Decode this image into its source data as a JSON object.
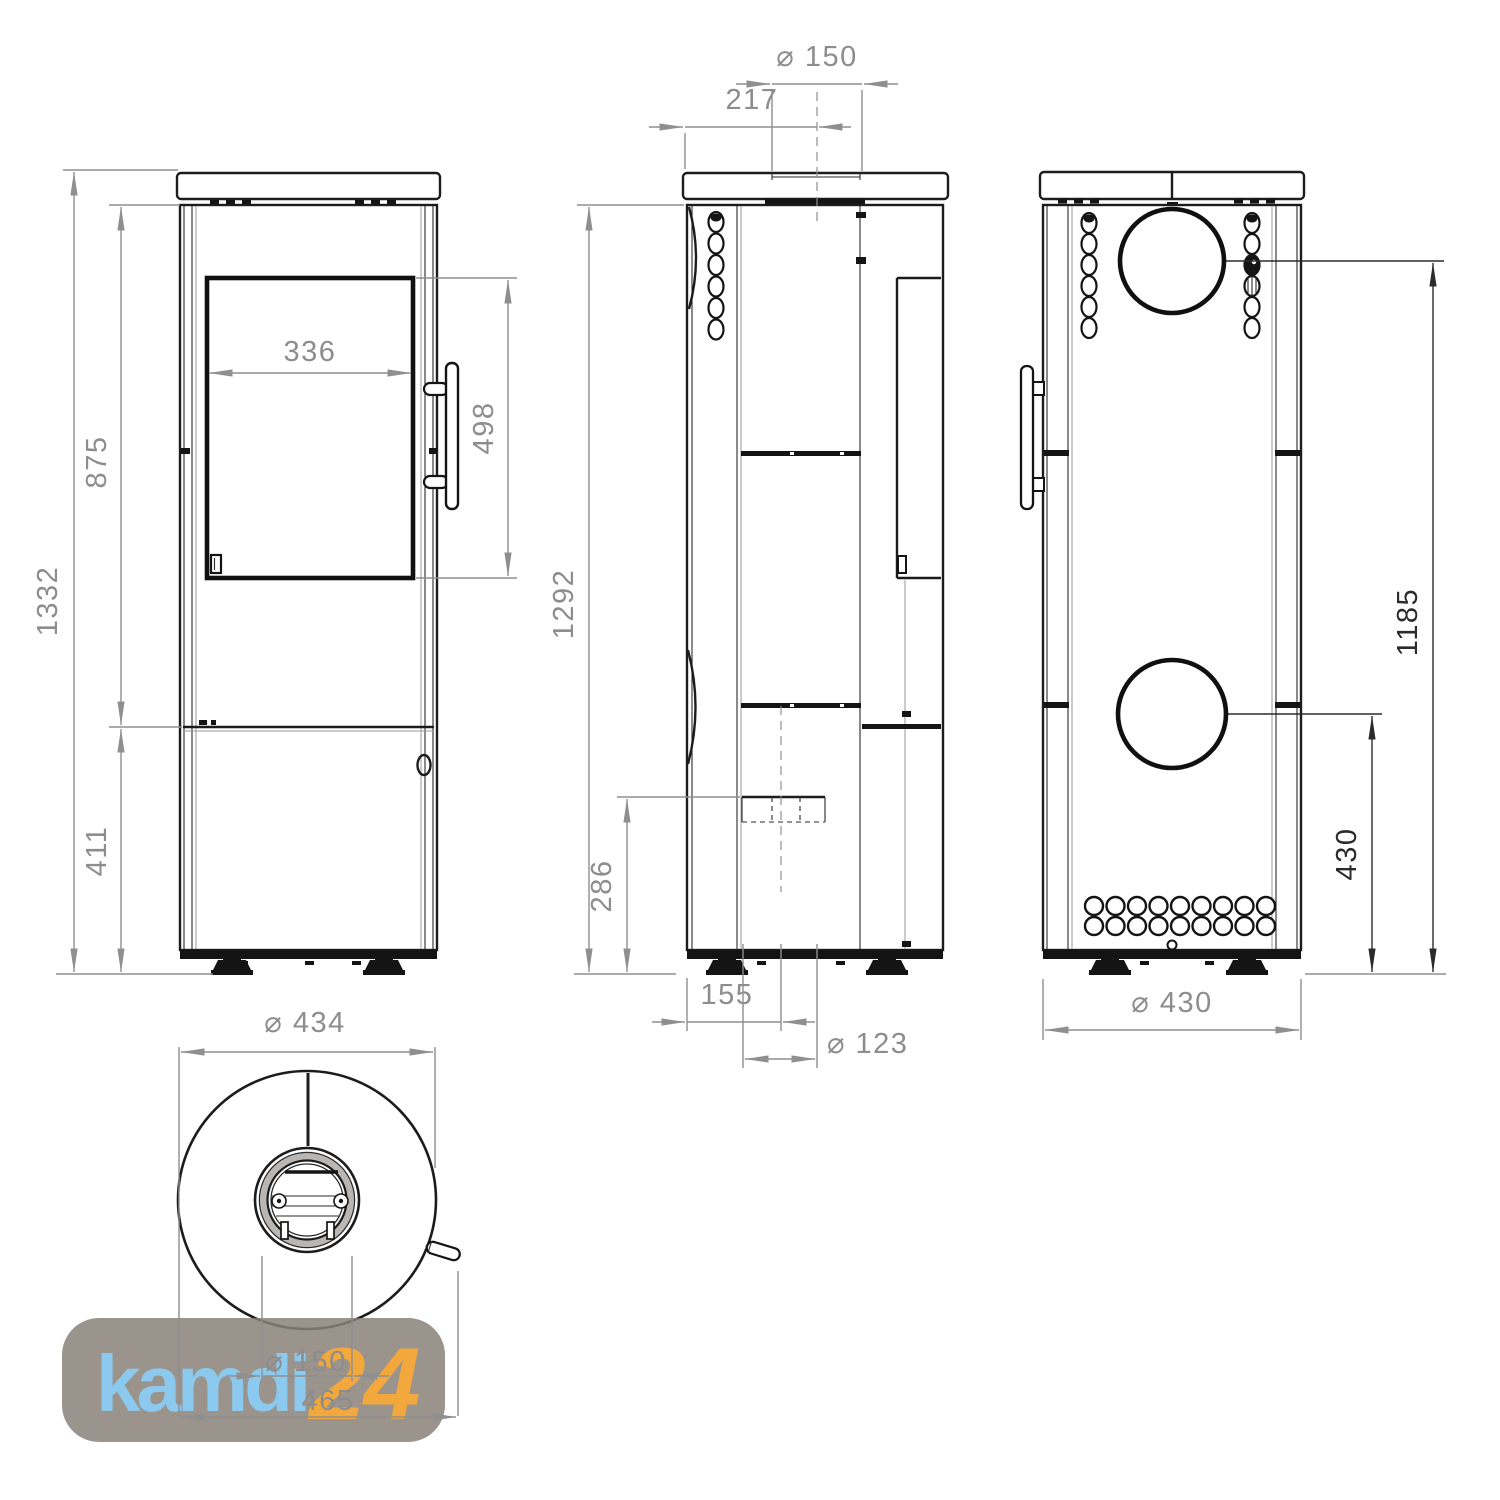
{
  "drawing": {
    "type": "technical-dimension-drawing",
    "subject": "freestanding wood stove, four orthographic views",
    "line_color": "#1c1c1c",
    "dimension_color": "#8f8f8f",
    "dimension_dark_color": "#2b2b2b"
  },
  "front_view": {
    "overall_height": "1332",
    "upper_section_height": "875",
    "lower_section_height": "411",
    "glass_width": "336",
    "glass_height": "498"
  },
  "side_view": {
    "body_height": "1292",
    "flue_diameter": "⌀ 150",
    "flue_offset_from_front": "217",
    "air_inlet_height": "286",
    "air_inlet_offset_from_front": "155",
    "air_inlet_diameter": "⌀ 123"
  },
  "back_view": {
    "flue_center_height": "1185",
    "air_inlet_center_height": "430",
    "body_width": "⌀ 430"
  },
  "top_view": {
    "body_diameter": "⌀ 434",
    "flue_collar_diameter": "⌀ 150",
    "depth_with_handle": "465"
  },
  "watermark": {
    "brand_name": "kamdi",
    "brand_number": "24",
    "background_color": "#8a8179",
    "name_color": "#8cc9ee",
    "number_color": "#f3a83d"
  }
}
